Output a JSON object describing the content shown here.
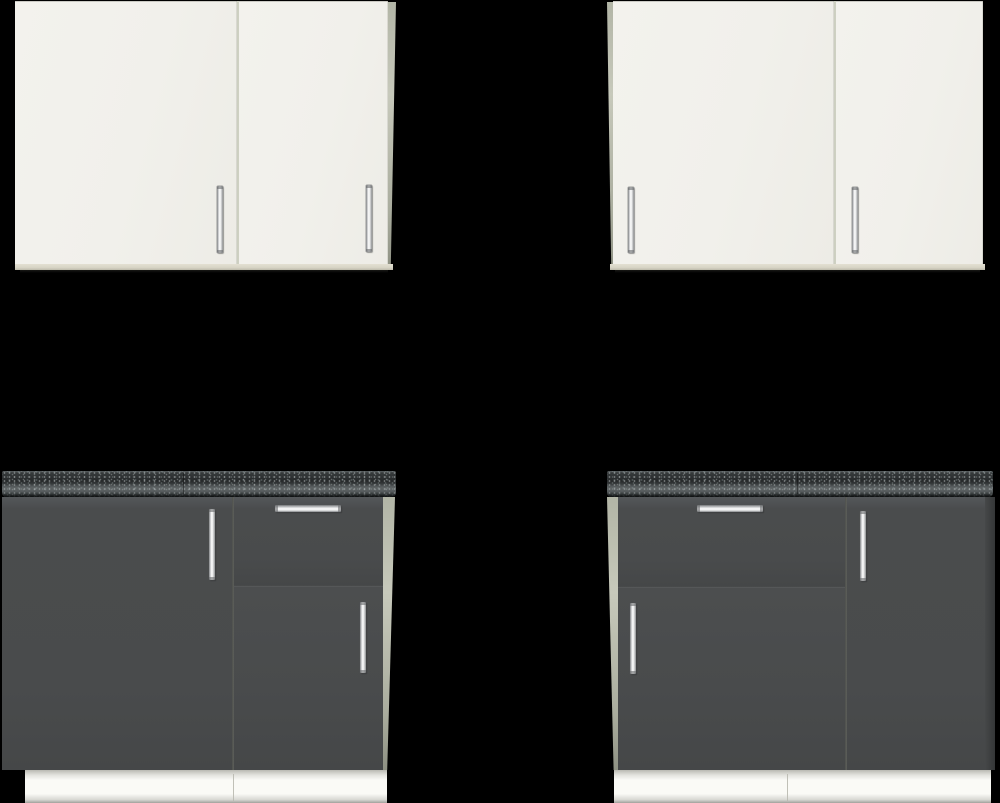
{
  "scene": {
    "type": "product-collage",
    "background": "#000000",
    "items": [
      {
        "id": "wall-cabinet-left",
        "kind": "wall cabinet",
        "finish": "white",
        "doors": 2,
        "handles": "vertical chrome bars near door bottoms"
      },
      {
        "id": "wall-cabinet-right",
        "kind": "wall cabinet",
        "finish": "white",
        "doors": 2,
        "handles": "vertical chrome bars near door bottoms"
      },
      {
        "id": "base-cabinet-left",
        "kind": "base cabinet",
        "finish": "graphite",
        "worktop": "black speckled stone",
        "layout": "full-height door left, drawer over door right",
        "plinth": "white"
      },
      {
        "id": "base-cabinet-right",
        "kind": "base cabinet",
        "finish": "graphite",
        "worktop": "black speckled stone",
        "layout": "drawer over door left, full-height door right",
        "plinth": "white"
      }
    ]
  },
  "palette": {
    "background": "#000000",
    "cabinet_white": "#f1f0eb",
    "cabinet_white_edge": "#d7d4c5",
    "side_panel_light": "#b9bcac",
    "white_door_seam": "#c2c5b5",
    "cabinet_dark": "#494b4c",
    "dark_door_seam": "#7c7e76",
    "countertop_base": "#26292a",
    "countertop_speckle": "#9ea6a8",
    "plinth_white": "#fafaf6",
    "handle_chrome": "#fdfdfd"
  }
}
